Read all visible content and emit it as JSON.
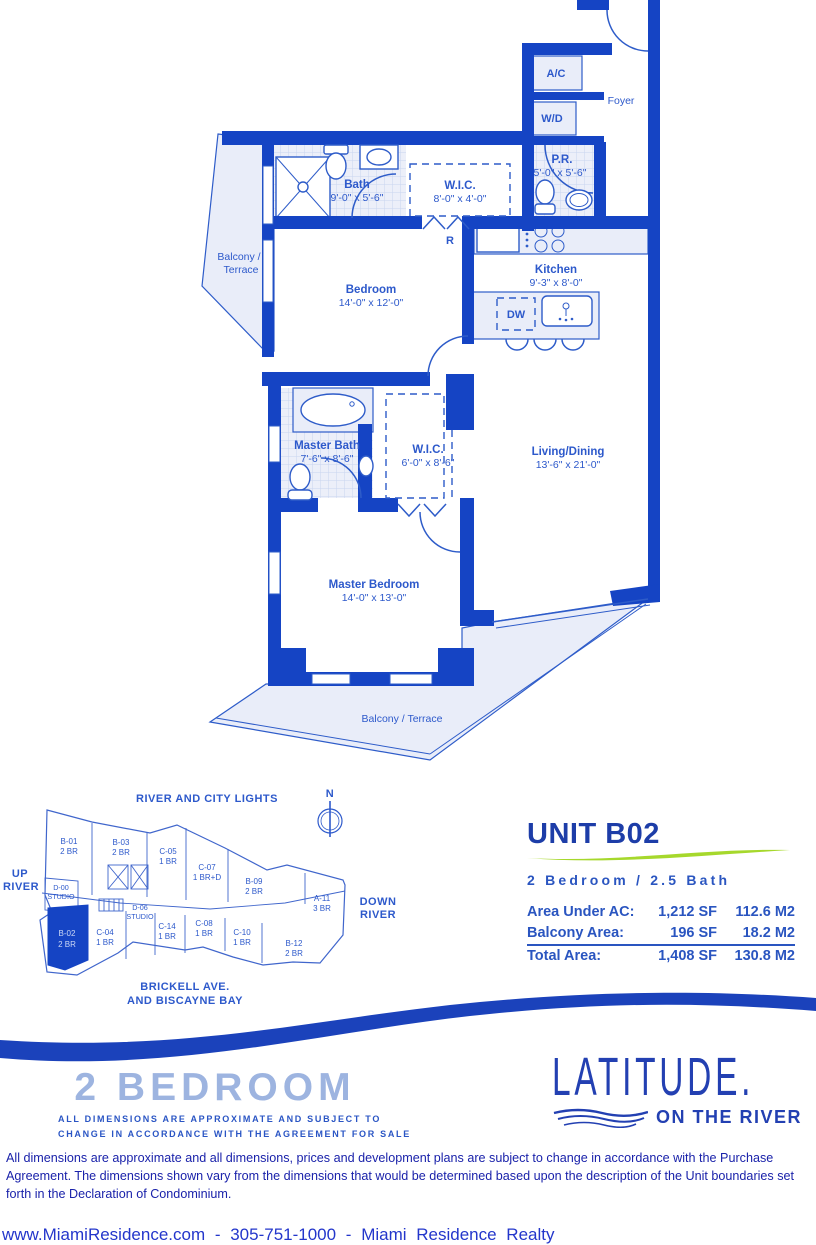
{
  "plan": {
    "rooms": {
      "foyer": {
        "name": "Foyer"
      },
      "bath": {
        "name": "Bath",
        "dims": "9'-0\" x 5'-6\""
      },
      "wic1": {
        "name": "W.I.C.",
        "dims": "8'-0\" x 4'-0\""
      },
      "pr": {
        "name": "P.R.",
        "dims": "5'-0\" x 5'-6\""
      },
      "kitchen": {
        "name": "Kitchen",
        "dims": "9'-3\" x 8'-0\""
      },
      "bedroom": {
        "name": "Bedroom",
        "dims": "14'-0\" x 12'-0\""
      },
      "balcony_top": {
        "line1": "Balcony /",
        "line2": "Terrace"
      },
      "master_bath": {
        "name": "Master Bath",
        "dims": "7'-6\" x 8'-6\""
      },
      "wic2": {
        "name": "W.I.C.",
        "dims": "6'-0\" x 8'-6\""
      },
      "living": {
        "name": "Living/Dining",
        "dims": "13'-6\" x 21'-0\""
      },
      "master_bedroom": {
        "name": "Master Bedroom",
        "dims": "14'-0\" x 13'-0\""
      },
      "balcony_bottom": {
        "name": "Balcony / Terrace"
      }
    },
    "appliances": {
      "ac": "A/C",
      "wd": "W/D",
      "dw": "DW",
      "fridge": "R"
    }
  },
  "keyplan": {
    "compass": "N",
    "edges": {
      "top": "RIVER AND CITY LIGHTS",
      "left1": "UP",
      "left2": "RIVER",
      "right1": "DOWN",
      "right2": "RIVER",
      "bottom1": "BRICKELL AVE.",
      "bottom2": "AND BISCAYNE BAY"
    },
    "units": [
      {
        "id": "B-01",
        "type": "2 BR"
      },
      {
        "id": "B-03",
        "type": "2 BR"
      },
      {
        "id": "C-05",
        "type": "1 BR"
      },
      {
        "id": "C-07",
        "type": "1 BR+D"
      },
      {
        "id": "B-09",
        "type": "2 BR"
      },
      {
        "id": "A-11",
        "type": "3 BR"
      },
      {
        "id": "D-00",
        "type": "STUDIO"
      },
      {
        "id": "D-06",
        "type": "STUDIO"
      },
      {
        "id": "C-14",
        "type": "1 BR"
      },
      {
        "id": "C-04",
        "type": "1 BR"
      },
      {
        "id": "B-02",
        "type": "2 BR"
      },
      {
        "id": "C-08",
        "type": "1 BR"
      },
      {
        "id": "C-10",
        "type": "1 BR"
      },
      {
        "id": "B-12",
        "type": "2 BR"
      }
    ]
  },
  "info": {
    "unit_title": "UNIT B02",
    "subtitle": "2 Bedroom / 2.5 Bath",
    "specs": [
      {
        "label": "Area Under AC:",
        "sf": "1,212 SF",
        "m2": "112.6 M2"
      },
      {
        "label": "Balcony Area:",
        "sf": "196 SF",
        "m2": "18.2 M2"
      },
      {
        "label": "Total Area:",
        "sf": "1,408 SF",
        "m2": "130.8 M2"
      }
    ]
  },
  "footer_block": {
    "plan_type": "2 BEDROOM",
    "fine_print_1": "ALL DIMENSIONS ARE APPROXIMATE AND SUBJECT TO",
    "fine_print_2": "CHANGE IN ACCORDANCE WITH THE AGREEMENT FOR SALE",
    "logo_name": "LATITUDE.",
    "logo_sub": "ON THE RIVER",
    "disclaimer": "All dimensions are approximate and all dimensions, prices and development plans are subject to change in accordance with the Purchase Agreement. The dimensions shown vary from the dimensions that would be determined based upon the description of the Unit boundaries set forth in the Declaration of Condominium.",
    "contact": "www.MiamiResidence.com - 305-751-1000 - Miami Residence Realty"
  },
  "colors": {
    "wall_blue": "#1544c4",
    "line_blue": "#2e5cc9",
    "light_fill": "#e9edf9",
    "label_blue": "#2d59cb",
    "navy": "#1d3da8",
    "green_swoosh": "#a6d82c",
    "periwinkle": "#9db4e0",
    "disclaimer_blue": "#1a22aa",
    "footer_blue": "#2336cb"
  }
}
